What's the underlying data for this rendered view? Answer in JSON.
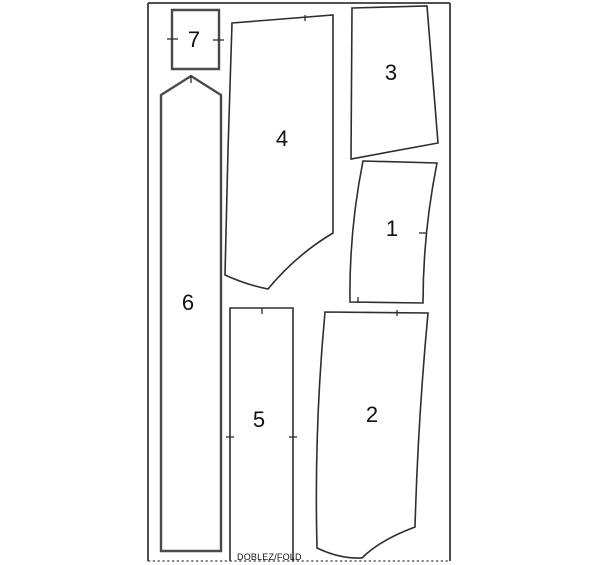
{
  "sheet": {
    "background": "#ffffff",
    "stroke_color": "#2e2e2e",
    "frame": {
      "stroke": "#3a3a3a",
      "lines": [
        {
          "name": "sheet-border-top",
          "d": "M148,3 L450,3",
          "dashed": false
        },
        {
          "name": "sheet-border-left",
          "d": "M148,3 L148,561",
          "dashed": false
        },
        {
          "name": "sheet-border-right",
          "d": "M450,3 L450,561",
          "dashed": false
        },
        {
          "name": "fold-line-bottom",
          "d": "M148,561 L450,561",
          "dashed": true
        }
      ]
    },
    "fold_label": {
      "text": "DOBLEZ/FOLD",
      "x": 237,
      "y": 560
    },
    "pieces": [
      {
        "number": "1",
        "label": {
          "x": 392,
          "y": 236
        },
        "outline": "M363,161 L437,163 Q423,233 423,303 L350,302 Q349,231 363,161 Z",
        "bold": false,
        "ticks": [
          "M358,297 L358,303",
          "M419,233 L427,233"
        ]
      },
      {
        "number": "2",
        "label": {
          "x": 372,
          "y": 422
        },
        "outline": "M325,312 L428,313 Q418,420 415,527 Q380,540 362,558 Q340,559 317,548 Q314,430 325,312 Z",
        "bold": false,
        "ticks": [
          "M397,310 L397,316"
        ]
      },
      {
        "number": "3",
        "label": {
          "x": 391,
          "y": 80
        },
        "outline": "M352,8 L427,6 L438,143 L351,159 Z",
        "bold": false,
        "ticks": []
      },
      {
        "number": "4",
        "label": {
          "x": 282,
          "y": 146
        },
        "outline": "M232,23 L333,15 L333,233 Q296,255 268,289 Q247,285 225,275 L228,150 Z",
        "bold": false,
        "ticks": [
          "M305,15 L305,21"
        ]
      },
      {
        "number": "5",
        "label": {
          "x": 259,
          "y": 427
        },
        "outline": "M230,561 L230,308 L293,308 L293,561",
        "bold": false,
        "ticks": [
          "M262,308 L262,314",
          "M226,437 L234,437",
          "M289,437 L297,437"
        ]
      },
      {
        "number": "6",
        "label": {
          "x": 188,
          "y": 310
        },
        "outline": "M161,551 L161,95 L191,76 L221,95 L221,551 Z",
        "bold": true,
        "ticks": [
          "M191,76 L191,83"
        ]
      },
      {
        "number": "7",
        "label": {
          "x": 194,
          "y": 47
        },
        "outline": "M172,10 L219,10 L219,69 L172,69 Z",
        "bold": true,
        "ticks": [
          "M167,39 L178,39",
          "M213,40 L224,40"
        ]
      }
    ]
  }
}
